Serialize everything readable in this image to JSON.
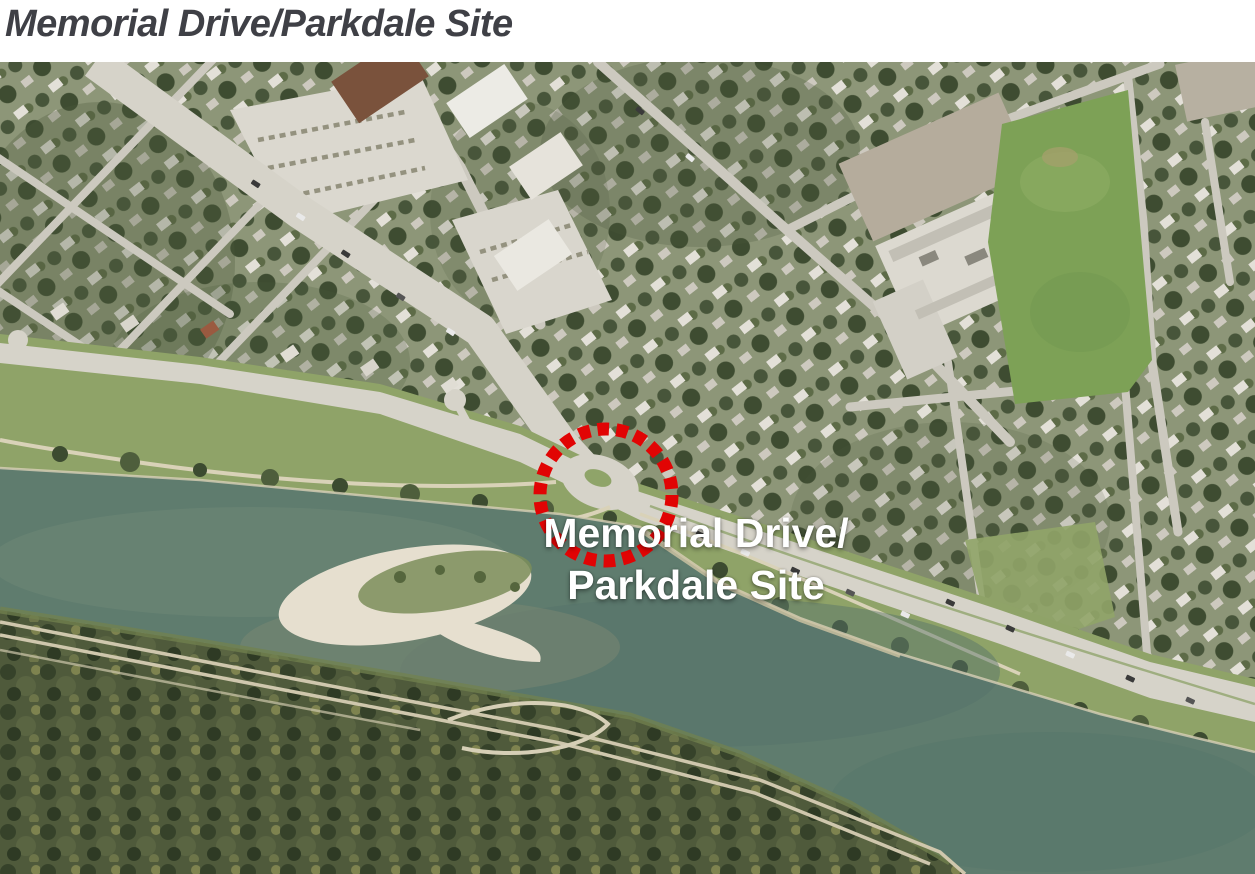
{
  "header": {
    "title": "Memorial Drive/Parkdale Site"
  },
  "map": {
    "label": {
      "line1": "Memorial Drive/",
      "line2": "Parkdale Site"
    },
    "marker": {
      "shape": "dashed-circle",
      "color": "#e10404"
    },
    "colors": {
      "river": "#5f7c6e",
      "bank_grass": "#8fa368",
      "road": "#d6d3c9",
      "sand": "#e6dfcf",
      "forest_base": "#4f5a3b",
      "residential_base": "#8d9678",
      "field": "#7da156",
      "title_text": "#3f4046",
      "label_text": "#ffffff"
    }
  }
}
